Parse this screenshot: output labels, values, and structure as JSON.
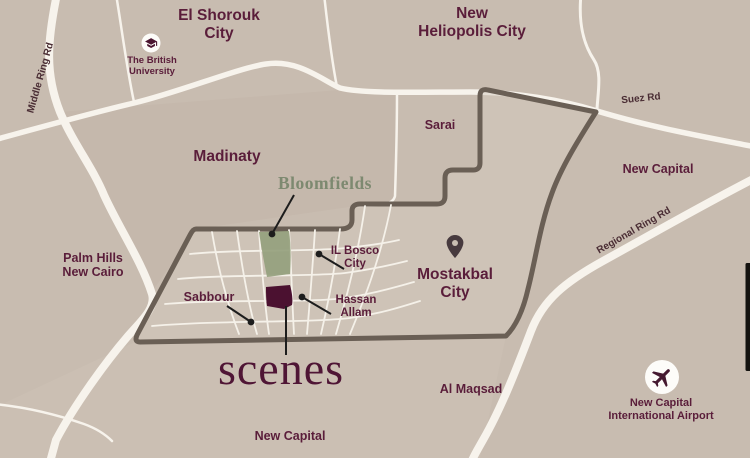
{
  "map": {
    "type": "location-map",
    "project_logo": "scenes",
    "labels": {
      "el_shorouk": {
        "line1": "El Shorouk",
        "line2": "City"
      },
      "new_heliopolis": {
        "line1": "New",
        "line2": "Heliopolis City"
      },
      "british_university": {
        "line1": "The British",
        "line2": "University"
      },
      "middle_ring_rd": "Middle Ring Rd",
      "madinaty": "Madinaty",
      "sarai": "Sarai",
      "suez_rd": "Suez Rd",
      "new_capital_northeast": "New Capital",
      "regional_ring_rd": "Regional Ring Rd",
      "palm_hills": {
        "line1": "Palm Hills",
        "line2": "New Cairo"
      },
      "bloomfields": "Bloomfields",
      "il_bosco": {
        "line1": "IL Bosco",
        "line2": "City"
      },
      "mostakbal": {
        "line1": "Mostakbal",
        "line2": "City"
      },
      "sabbour": "Sabbour",
      "hassan_allam": {
        "line1": "Hassan",
        "line2": "Allam"
      },
      "scenes_logo": "scenes",
      "al_maqsad": "Al Maqsad",
      "new_capital_south": "New Capital",
      "airport": {
        "line1": "New Capital",
        "line2": "International Airport"
      }
    },
    "icons": {
      "university": "graduation-cap-icon",
      "mostakbal_city": "location-pin-icon",
      "airport": "airplane-icon"
    },
    "colors": {
      "background": "#c8bcb0",
      "road_white": "#f7f3ec",
      "boundary_gray": "#6a5f55",
      "label_maroon": "#5a1d3a",
      "road_label_brown": "#4a2d34",
      "bloomfields_sage": "#7d8970",
      "bloomfields_block": "#95a17d",
      "scenes_block": "#4b1130",
      "scenes_logo": "#4f1535",
      "pointer_black": "#1d1d1d"
    }
  }
}
